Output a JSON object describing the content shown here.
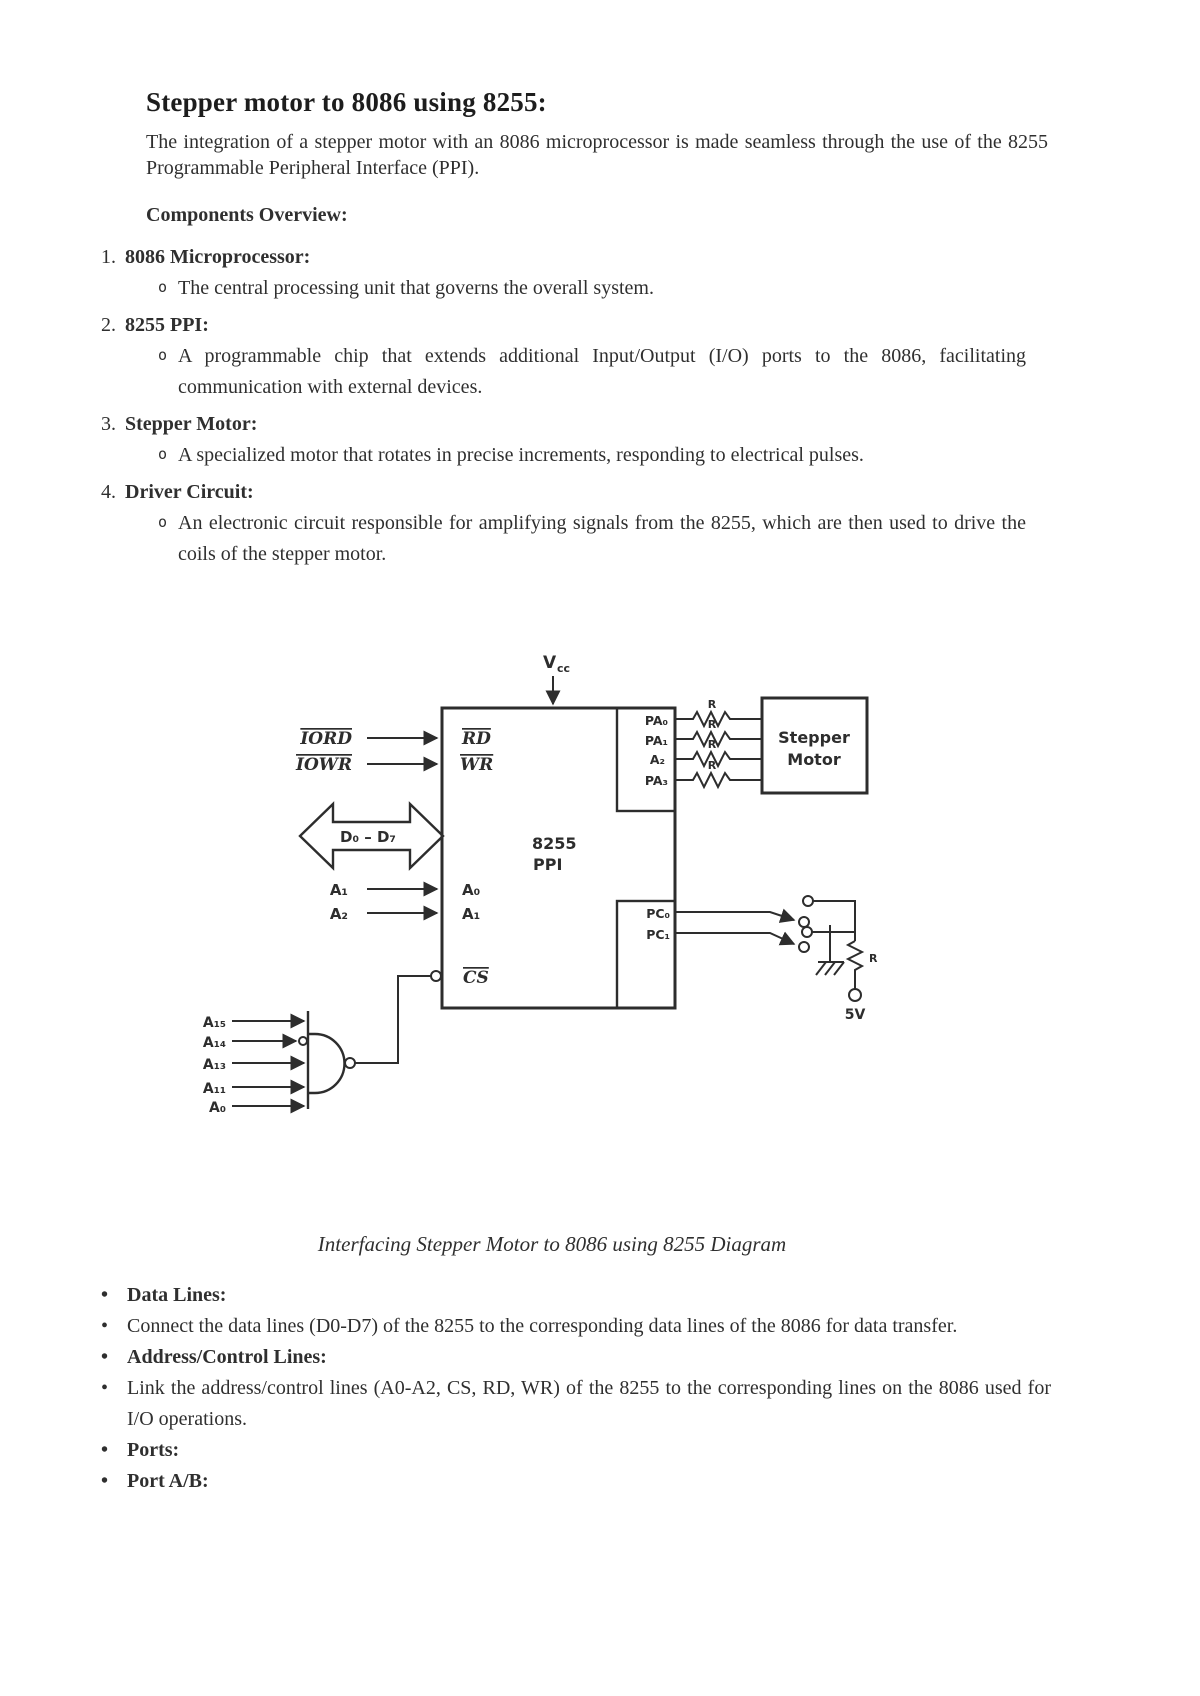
{
  "page": {
    "title": "Stepper motor to 8086 using 8255:",
    "intro": "The integration of a stepper motor with an 8086 microprocessor is made seamless through the use of the 8255 Programmable Peripheral Interface (PPI).",
    "section_heading": "Components Overview:",
    "components": [
      {
        "marker": "1.",
        "title": "8086 Microprocessor:",
        "sub_marker": "o",
        "detail": "The central processing unit that governs the overall system."
      },
      {
        "marker": "2.",
        "title": "8255 PPI:",
        "sub_marker": "o",
        "detail": "A programmable chip that extends additional Input/Output (I/O) ports to the 8086, facilitating communication with external devices."
      },
      {
        "marker": "3.",
        "title": "Stepper Motor:",
        "sub_marker": "o",
        "detail": "A specialized motor that rotates in precise increments, responding to electrical pulses."
      },
      {
        "marker": "4.",
        "title": "Driver Circuit:",
        "sub_marker": "o",
        "detail": "An electronic circuit responsible for amplifying signals from the 8255, which are then used to drive the coils of the stepper motor."
      }
    ],
    "caption": "Interfacing Stepper Motor to 8086 using 8255 Diagram",
    "bullets": [
      {
        "marker": "•",
        "text": "Data Lines:"
      },
      {
        "marker": "•",
        "text": "Connect the data lines (D0-D7) of the 8255 to the corresponding data lines of the 8086 for data transfer."
      },
      {
        "marker": "•",
        "text": "Address/Control Lines:"
      },
      {
        "marker": "•",
        "text": "Link the address/control lines (A0-A2, CS, RD, WR) of the 8255 to the corresponding lines on the 8086 used for I/O operations."
      },
      {
        "marker": "•",
        "text": "Ports:"
      },
      {
        "marker": "•",
        "text": "Port A/B:"
      }
    ]
  },
  "diagram": {
    "chip_label_line1": "8255",
    "chip_label_line2": "PPI",
    "vcc_main": "V",
    "vcc_sub": "cc",
    "iord": "IORD",
    "iowr": "IOWR",
    "rd": "RD",
    "wr": "WR",
    "data_bus": "D₀ – D₇",
    "addr_a1": "A₁",
    "addr_a2": "A₂",
    "pin_a0": "A₀",
    "pin_a1": "A₁",
    "cs": "CS",
    "port_a_pins": [
      "PA₀",
      "PA₁",
      "A₂",
      "PA₃"
    ],
    "port_c_pins": [
      "PC₀",
      "PC₁"
    ],
    "resistor_label": "R",
    "stepper_line1": "Stepper",
    "stepper_line2": "Motor",
    "supply": "5V",
    "nand_inputs": [
      "A₁₅",
      "A₁₄",
      "A₁₃",
      "A₁₁",
      "A₀"
    ],
    "ink_color": "#2d2d2d"
  }
}
